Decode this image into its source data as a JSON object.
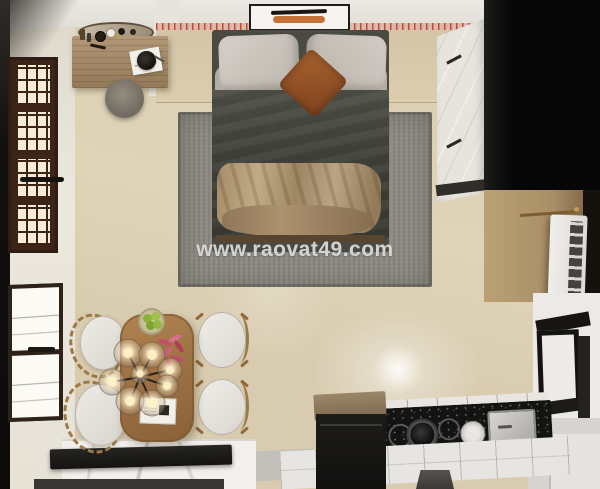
{
  "scene": {
    "type": "3d-interior-render",
    "view": "top-down",
    "description": "Top-down render of a small studio apartment: double bed on grey rug, vanity desk, shuttered door and window on the left, white wardrobe and dark unit on the right, kitchenette with black granite counter at bottom right, marble island and wooden dining table with four chairs and a globe chandelier at bottom left"
  },
  "watermark": {
    "text": "www.raovat49.com",
    "color": "#ececec"
  },
  "palette": {
    "floor": "#dcd0b5",
    "wall_band": "#d4c5a6",
    "ceiling": "#ece9e4",
    "rug": "#8f8c85",
    "duvet": "#45463e",
    "blanket": "#b49c7a",
    "pillow": "#ccc6bf",
    "accent_pillow": "#a25d2c",
    "door_wood": "#3c2418",
    "desk_wood": "#a88a64",
    "table_wood": "#a87a48",
    "wardrobe": "#e7e4de",
    "dark_unit": "#0a0a09",
    "granite": "#131311",
    "marble": "#f2f0ed",
    "artwork_orange": "#c4713a"
  },
  "labels": {
    "bed": "double bed with dark duvet and tan throw blanket",
    "rug": "grey area rug",
    "artwork": "abstract wall art",
    "vanity_desk": "wooden vanity desk with mirror and cosmetics",
    "stool": "round grey stool",
    "door": "dark wood shuttered door",
    "window": "casement window",
    "wardrobe": "white wardrobe",
    "ac_unit": "white appliance with vent grille",
    "kitchen_counter": "black granite counter with cooktop and sink",
    "island": "white marble island with black slab",
    "dining_table": "wooden dining table",
    "chandelier": "glass globe chandelier",
    "fruit_bowl": "bowl of green apples",
    "flowers": "red flower arrangement",
    "chairs": "four dining chairs"
  }
}
